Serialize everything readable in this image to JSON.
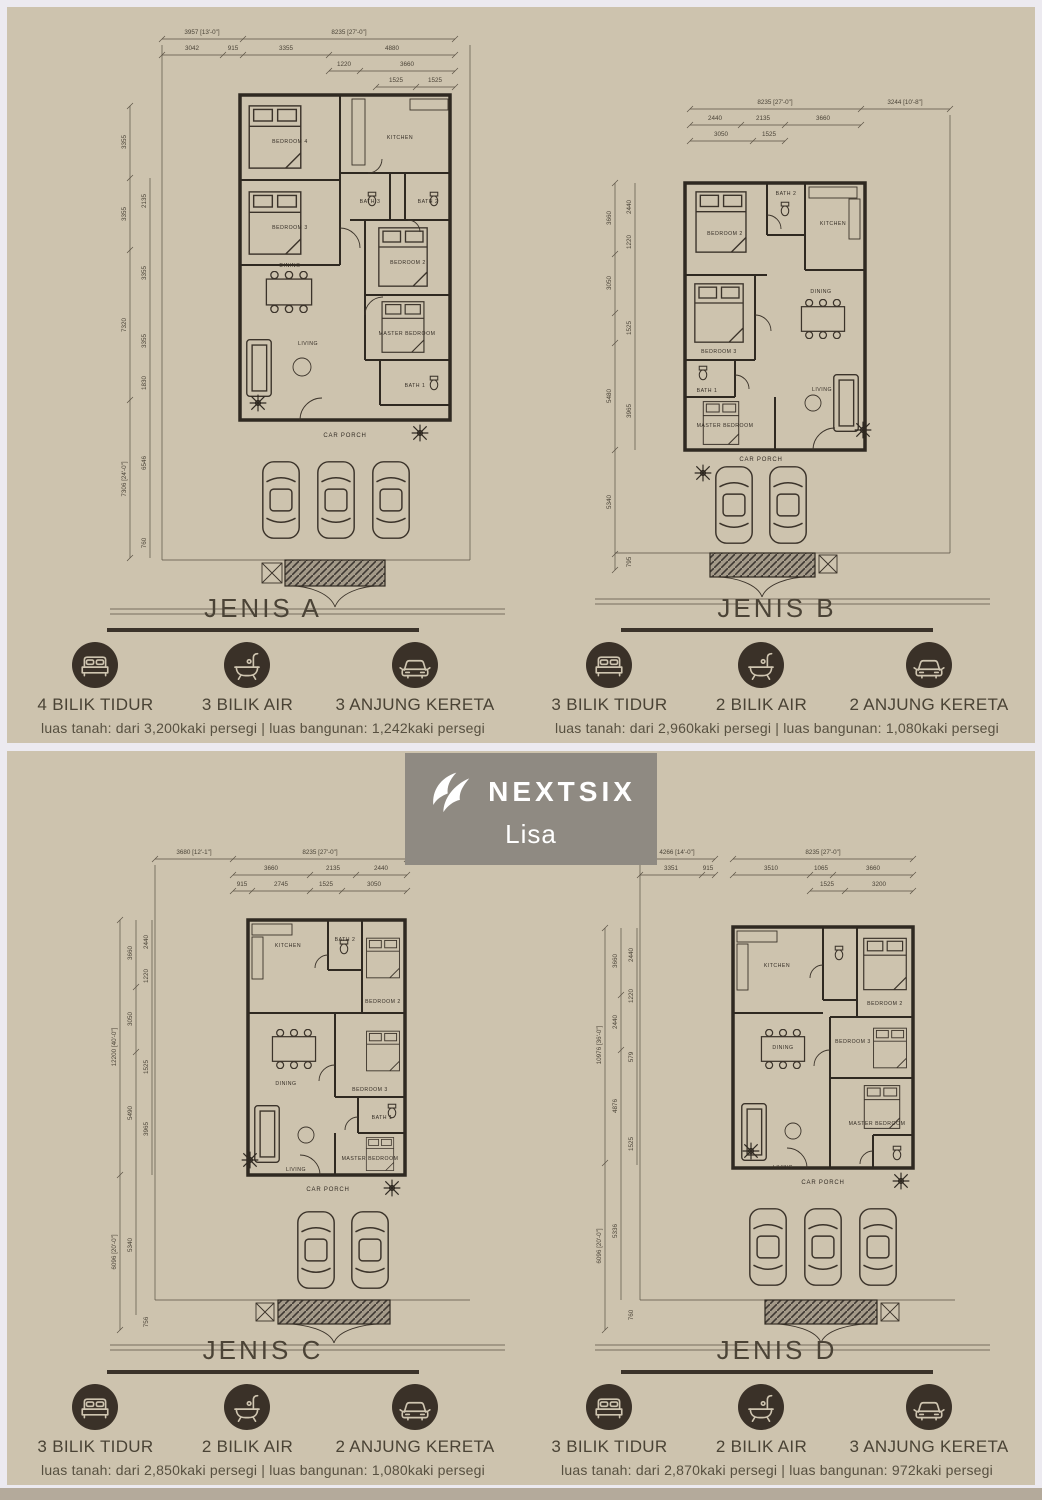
{
  "page": {
    "panel_bg": "#cdc3ae",
    "separator": "#eceaf0",
    "bottom_bar": "#b4aa9b",
    "line_color": "#2f2921",
    "accent_dark": "#3a3128"
  },
  "logo": {
    "brand": "NEXTSIX",
    "agent": "Lisa"
  },
  "plans": [
    {
      "id": "A",
      "title": "JENIS A",
      "rooms": [
        "BEDROOM 4",
        "KITCHEN",
        "BEDROOM 3",
        "BATH 3",
        "BATH 2",
        "BEDROOM 2",
        "DINING",
        "MASTER BEDROOM",
        "LIVING",
        "BATH 1",
        "CAR PORCH"
      ],
      "dims_top": [
        "3957 [13'-0\"]",
        "8235 [27'-0\"]",
        "3042",
        "915",
        "3355",
        "4880",
        "1220",
        "3660",
        "1525",
        "1525"
      ],
      "dims_left": [
        "3355",
        "3355",
        "7320",
        "7306 [24'-0\"]",
        "2135",
        "3355",
        "3355",
        "1830",
        "6546",
        "760"
      ],
      "features": [
        {
          "icon": "bed",
          "label": "4 BILIK TIDUR"
        },
        {
          "icon": "bath",
          "label": "3 BILIK AIR"
        },
        {
          "icon": "car",
          "label": "3 ANJUNG KERETA"
        }
      ],
      "specs": "luas tanah: dari 3,200kaki persegi | luas bangunan: 1,242kaki persegi"
    },
    {
      "id": "B",
      "title": "JENIS B",
      "rooms": [
        "BEDROOM 2",
        "BATH 2",
        "KITCHEN",
        "BEDROOM 3",
        "DINING",
        "BATH 1",
        "MASTER BEDROOM",
        "LIVING",
        "CAR PORCH"
      ],
      "dims_top": [
        "8235 [27'-0\"]",
        "3244 [10'-8\"]",
        "2440",
        "2135",
        "3660",
        "3050",
        "1525"
      ],
      "dims_left": [
        "3660",
        "3050",
        "5480",
        "5340",
        "2440",
        "1220",
        "1525",
        "3965",
        "795"
      ],
      "features": [
        {
          "icon": "bed",
          "label": "3 BILIK TIDUR"
        },
        {
          "icon": "bath",
          "label": "2 BILIK AIR"
        },
        {
          "icon": "car",
          "label": "2 ANJUNG KERETA"
        }
      ],
      "specs": "luas tanah: dari 2,960kaki persegi | luas bangunan: 1,080kaki persegi"
    },
    {
      "id": "C",
      "title": "JENIS C",
      "rooms": [
        "KITCHEN",
        "BATH 2",
        "BEDROOM 2",
        "DINING",
        "BEDROOM 3",
        "BATH 1",
        "LIVING",
        "MASTER BEDROOM",
        "CAR PORCH"
      ],
      "dims_top": [
        "3680 [12'-1\"]",
        "8235 [27'-0\"]",
        "3660",
        "2135",
        "2440",
        "915",
        "2745",
        "1525",
        "3050"
      ],
      "dims_left": [
        "12200 [40'-0\"]",
        "6096 [20'-0\"]",
        "3660",
        "3050",
        "5490",
        "5340",
        "2440",
        "1220",
        "1525",
        "3965",
        "756"
      ],
      "features": [
        {
          "icon": "bed",
          "label": "3 BILIK TIDUR"
        },
        {
          "icon": "bath",
          "label": "2 BILIK AIR"
        },
        {
          "icon": "car",
          "label": "2 ANJUNG KERETA"
        }
      ],
      "specs": "luas tanah: dari 2,850kaki persegi | luas bangunan: 1,080kaki persegi"
    },
    {
      "id": "D",
      "title": "JENIS D",
      "rooms": [
        "KITCHEN",
        "BEDROOM 2",
        "DINING",
        "BEDROOM 3",
        "LIVING",
        "MASTER BEDROOM",
        "CAR PORCH"
      ],
      "dims_top": [
        "4266 [14'-0\"]",
        "8235 [27'-0\"]",
        "3351",
        "915",
        "3510",
        "1065",
        "3660",
        "1525",
        "3200"
      ],
      "dims_left": [
        "10976 [36'-0\"]",
        "6096 [20'-0\"]",
        "3660",
        "2440",
        "4876",
        "5336",
        "2440",
        "1220",
        "579",
        "1525",
        "760"
      ],
      "features": [
        {
          "icon": "bed",
          "label": "3 BILIK TIDUR"
        },
        {
          "icon": "bath",
          "label": "2 BILIK AIR"
        },
        {
          "icon": "car",
          "label": "3 ANJUNG KERETA"
        }
      ],
      "specs": "luas tanah: dari 2,870kaki persegi | luas bangunan: 972kaki persegi"
    }
  ]
}
